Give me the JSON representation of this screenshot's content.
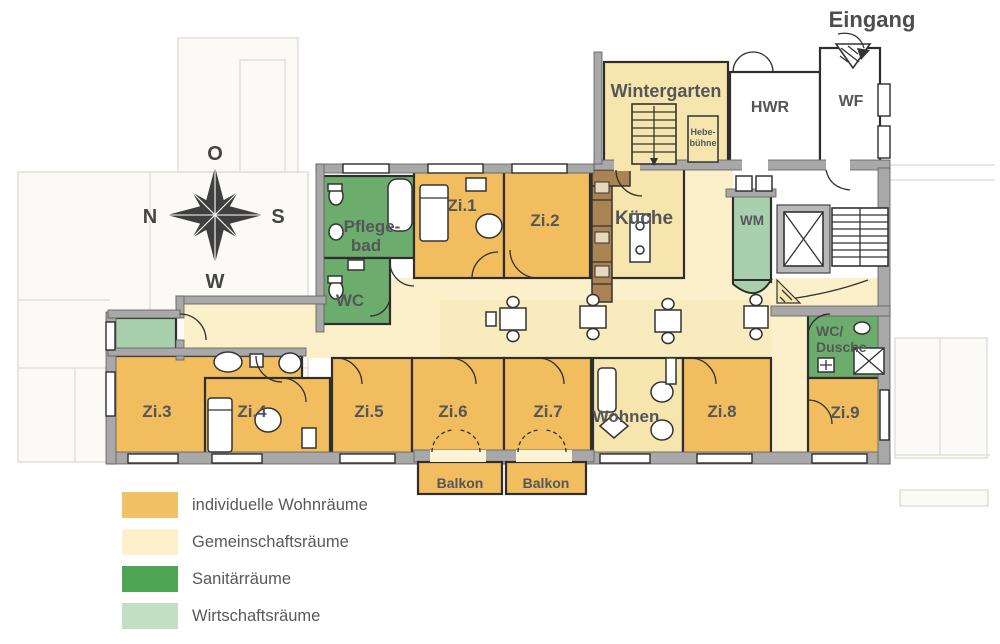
{
  "entrance": {
    "label": "Eingang"
  },
  "compass": {
    "top": "O",
    "left": "N",
    "right": "S",
    "bottom": "W"
  },
  "colors": {
    "individual": "#f1bd5f",
    "communal_deep": "#f6e5ad",
    "communal_light": "#fbf0ca",
    "sanitary": "#6cac6c",
    "utility": "#a9d0ad"
  },
  "rooms": {
    "wintergarten": {
      "label": "Wintergarten"
    },
    "hebebuehne": {
      "line1": "Hebe-",
      "line2": "bühne"
    },
    "hwr": {
      "label": "HWR"
    },
    "wf": {
      "label": "WF"
    },
    "pflegebad": {
      "line1": "Pflege-",
      "line2": "bad"
    },
    "wc": {
      "label": "WC"
    },
    "zi1": {
      "label": "Zi.1"
    },
    "zi2": {
      "label": "Zi.2"
    },
    "zi3": {
      "label": "Zi.3"
    },
    "zi4": {
      "label": "Zi.4"
    },
    "zi5": {
      "label": "Zi.5"
    },
    "zi6": {
      "label": "Zi.6"
    },
    "zi7": {
      "label": "Zi.7"
    },
    "zi8": {
      "label": "Zi.8"
    },
    "zi9": {
      "label": "Zi.9"
    },
    "kueche": {
      "label": "Küche"
    },
    "wm": {
      "label": "WM"
    },
    "wc_dusche": {
      "line1": "WC/",
      "line2": "Dusche"
    },
    "wohnen": {
      "label": "Wohnen"
    },
    "balkon1": {
      "label": "Balkon"
    },
    "balkon2": {
      "label": "Balkon"
    }
  },
  "legend": {
    "items": [
      {
        "label": "individuelle Wohnräume",
        "color": "#f2c166"
      },
      {
        "label": "Gemeinschaftsräume",
        "color": "#fdf0cb"
      },
      {
        "label": "Sanitärräume",
        "color": "#4da554"
      },
      {
        "label": "Wirtschaftsräume",
        "color": "#c2dfc5"
      }
    ]
  }
}
